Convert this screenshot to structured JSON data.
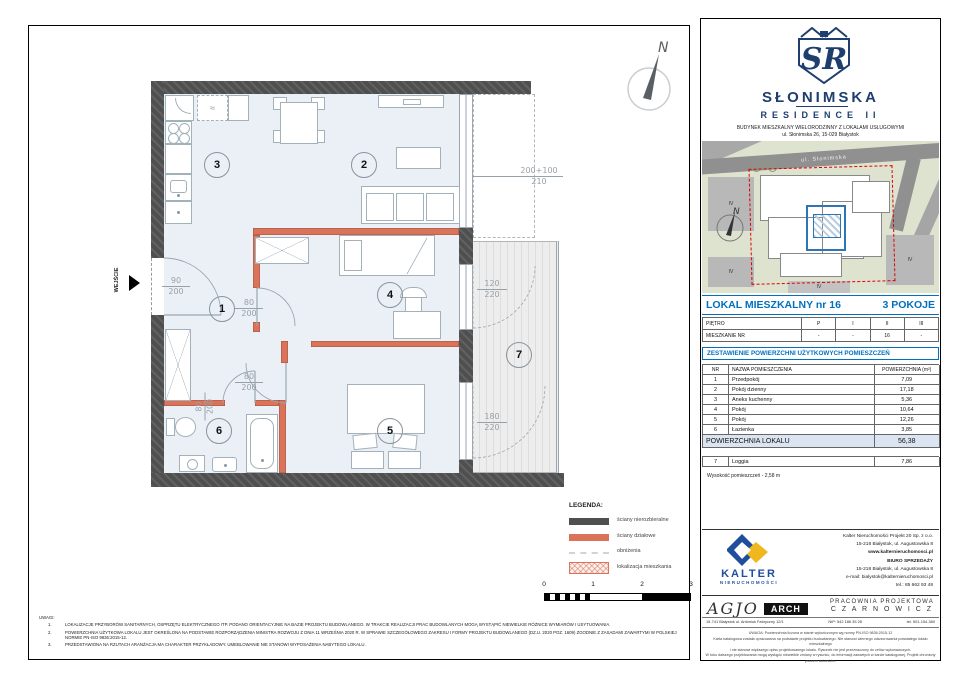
{
  "plan": {
    "entrance_label": "WEJŚCIE",
    "compass_label": "N",
    "appliance_symbol": "≈",
    "room_numbers": [
      "1",
      "2",
      "3",
      "4",
      "5",
      "6",
      "7"
    ],
    "dims": {
      "entry": {
        "w": "90",
        "h": "200"
      },
      "door_hall": {
        "w": "80",
        "h": "200"
      },
      "door_room5": {
        "w": "80",
        "h": "200"
      },
      "door_bath": {
        "w": "80",
        "h": "200"
      },
      "loggia_door": {
        "w": "120",
        "h": "220"
      },
      "loggia_window": {
        "w": "180",
        "h": "220"
      },
      "corner_window": {
        "w": "200+100",
        "h": "210"
      }
    },
    "legend": {
      "title": "LEGENDA:",
      "items": [
        {
          "label": "ściany nierozbieralne"
        },
        {
          "label": "ściany działowe"
        },
        {
          "label": "obniżenia"
        },
        {
          "label": "lokalizacja mieszkania"
        }
      ]
    },
    "scale": {
      "ticks": [
        "0",
        "1",
        "2",
        "3"
      ]
    },
    "notes_title": "UWAGI:",
    "notes": [
      {
        "num": "1.",
        "text": "LOKALIZACJE PRZYBORÓW SANITARNYCH, OSPRZĘTU ELEKTRYCZNEGO ITP. PODANO ORIENTACYJNIE NA BAZIE PROJEKTU BUDOWLANEGO. W TRAKCIE REALIZACJI PRAC BUDOWLANYCH MOGĄ WYSTĄPIĆ NIEWIELKIE RÓŻNICE WYMIARÓW I USYTUOWANIA."
      },
      {
        "num": "2.",
        "text": "POWIERZCHNIA UŻYTKOWA LOKALU JEST OKREŚLONA NA PODSTAWIE ROZPORZĄDZENIA MINISTRA ROZWOJU Z DNIA 11 WRZEŚNIA 2020 R. W SPRAWIE SZCZEGÓŁOWEGO ZAKRESU I FORMY PROJEKTU BUDOWLANEGO (DZ.U. 2020 POZ. 1609) ZGODNIE Z ZASADAMI ZAWARTYMI W POLSKIEJ NORMIE PN-ISO 9836:2015-12."
      },
      {
        "num": "3.",
        "text": "PRZEDSTAWIONA NA RZUTACH ARANŻACJA MA CHARAKTER PRZYKŁADOWY. UMEBLOWANIE NIE STANOWI WYPOSAŻENIA NABYTEGO LOKALU."
      }
    ]
  },
  "card": {
    "brand": {
      "monogram": "SR",
      "name": "SŁONIMSKA",
      "subname": "RESIDENCE II",
      "building_line": "BUDYNEK MIESZKALNY WIELORODZINNY Z LOKALAMI USŁUGOWYMI",
      "address_line": "ul. Słonimska 26, 15-029 Białystok"
    },
    "siteplan": {
      "street": "ul. Słonimska",
      "compass_label": "N",
      "building_labels": [
        "IV",
        "IV",
        "IV",
        "IV"
      ]
    },
    "unit": {
      "title": "LOKAL MIESZKALNY  nr 16",
      "rooms": "3 POKOJE"
    },
    "floor_table": {
      "row1": [
        "PIĘTRO",
        "P",
        "I",
        "II",
        "III"
      ],
      "row2": [
        "MIESZKANIE NR",
        "-",
        "-",
        "16",
        "-"
      ]
    },
    "area_section_title": "ZESTAWIENIE POWIERZCHNI UŻYTKOWYCH POMIESZCZEŃ",
    "area_table": {
      "headers": [
        "NR",
        "NAZWA POMIESZCZENIA",
        "POWIERZCHNIA (m²)"
      ],
      "rows": [
        [
          "1",
          "Przedpokój",
          "7,09"
        ],
        [
          "2",
          "Pokój dzienny",
          "17,18"
        ],
        [
          "3",
          "Aneks kuchenny",
          "5,36"
        ],
        [
          "4",
          "Pokój",
          "10,64"
        ],
        [
          "5",
          "Pokój",
          "12,26"
        ],
        [
          "6",
          "Łazienka",
          "3,85"
        ]
      ],
      "total_label": "POWIERZCHNIA LOKALU",
      "total_value": "56,38",
      "loggia_row": [
        "7",
        "Loggia",
        "7,86"
      ],
      "height_note": "Wysokość pomieszczeń - 2,58 m"
    },
    "developer": {
      "name": "KALTER",
      "sub": "NIERUCHOMOŚCI",
      "lines": [
        "Kalter Nieruchomości Projekt 20  Sp. z o.o.",
        "15-218 Białystok, ul. Augustowska 8",
        "www.kalternieruchomosci.pl",
        "BIURO SPRZEDAŻY",
        "15-218 Białystok, ul. Augustowska 8",
        "e-mail: bialystok@kalternieruchomosci.pl",
        "tel.: 85 662 93 48"
      ]
    },
    "studio": {
      "script": "AGJO",
      "badge": "ARCH",
      "line1": "PRACOWNIA  PROJEKTOWA",
      "line2": "C Z A R N O W I C Z",
      "address": "15-741 Białystok   ul. Antoniuk Fabryczny  12/1",
      "nip": "NIP:  542 186 35 28",
      "tel": "tel. 501-154-380"
    },
    "fineprint": [
      "UWAGA:   Powierzchnia liczona w stanie wykończonym wg normy PN-ISO 9836:2015-12",
      "Karta katalogowa została opracowana na podstawie projektu budowlanego.  Nie stanowi wiernego odwzorowania powstałego lokalu mieszkalnego",
      "i nie stanowi większego opisu projektowanego lokalu. Rysunek nie jest przeznaczony do celów wykonawczych.",
      "W toku dalszego projektowania mogą wystąpić niewielkie zmiany w rysunku, do informacji zawartych w karcie katalogowej. Projekt chroniony prawem autorskim."
    ]
  }
}
